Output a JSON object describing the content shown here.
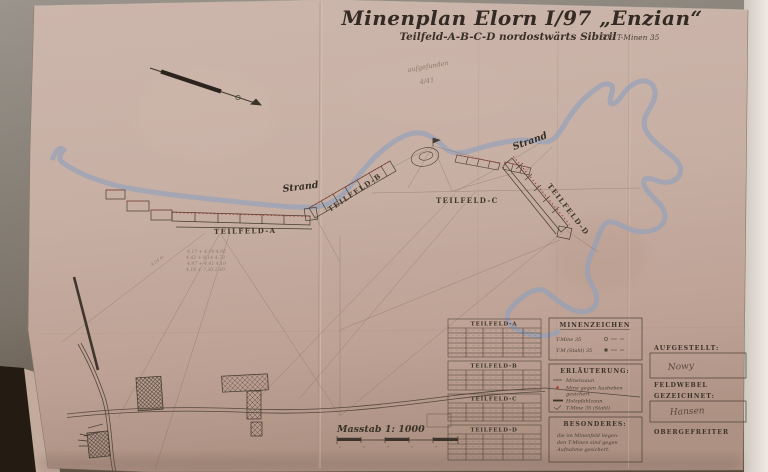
{
  "photo": {
    "backdrop_color": "#938c83",
    "paper_color": "#c7afa4",
    "ink_color": "#3c332a",
    "mine_red": "#b13527",
    "water_blue": "#8fa0bf"
  },
  "header": {
    "title": "Minenplan Elorn I/97 „Enzian“",
    "subtitle": "Teilfeld-A-B-C-D nordostwärts Sibiril",
    "subtitle_right": "506 T-Minen 35",
    "pencil_note_line1": "aufgefunden",
    "pencil_note_line2": "4/41"
  },
  "map": {
    "labels": {
      "strand_left": "Strand",
      "strand_right": "Strand",
      "teilfeld_a": "TEILFELD-A",
      "teilfeld_b": "TEILFELD-B",
      "teilfeld_c": "TEILFELD-C",
      "teilfeld_d": "TEILFELD-D"
    },
    "pencil_measurements": [
      "4,17 + 4,14   4,95",
      "4,42 + 8,14   4,73",
      "4,97 + 4,41   4,19",
      "4,18 + 7,30   2,49"
    ],
    "pencil_diag": "4,54 m",
    "scale_label": "Masstab 1: 1000"
  },
  "tables": {
    "a": {
      "title": "TEILFELD-A"
    },
    "b": {
      "title": "TEILFELD-B"
    },
    "c": {
      "title": "TEILFELD-C"
    },
    "d": {
      "title": "TEILFELD-D"
    }
  },
  "legend": {
    "minenzeichen": {
      "title": "MINENZEICHEN",
      "row1": "T-Mine 35",
      "row2": "T-M (Stahl) 35"
    },
    "erlaeuterung": {
      "title": "ERLÄUTERUNG:",
      "row1": "Minenzaun",
      "row2a": "Mine gegen Ausheben",
      "row2b": "gesichert",
      "row3": "Holzpfahlzaun",
      "row4": "T-Mine 35 (Stahl)"
    },
    "besonderes": {
      "title": "BESONDERES:",
      "line1": "die im Minenfeld liegen-",
      "line2": "den T-Minen sind gegen",
      "line3": "Aufnahme gesichert."
    }
  },
  "signatures": {
    "aufgestellt_label": "AUFGESTELLT:",
    "aufgestellt_signature": "Nowy",
    "feldwebel_label": "FELDWEBEL",
    "gezeichnet_label": "GEZEICHNET:",
    "gezeichnet_signature": "Hansen",
    "obergefreiter_label": "OBERGEFREITER"
  }
}
